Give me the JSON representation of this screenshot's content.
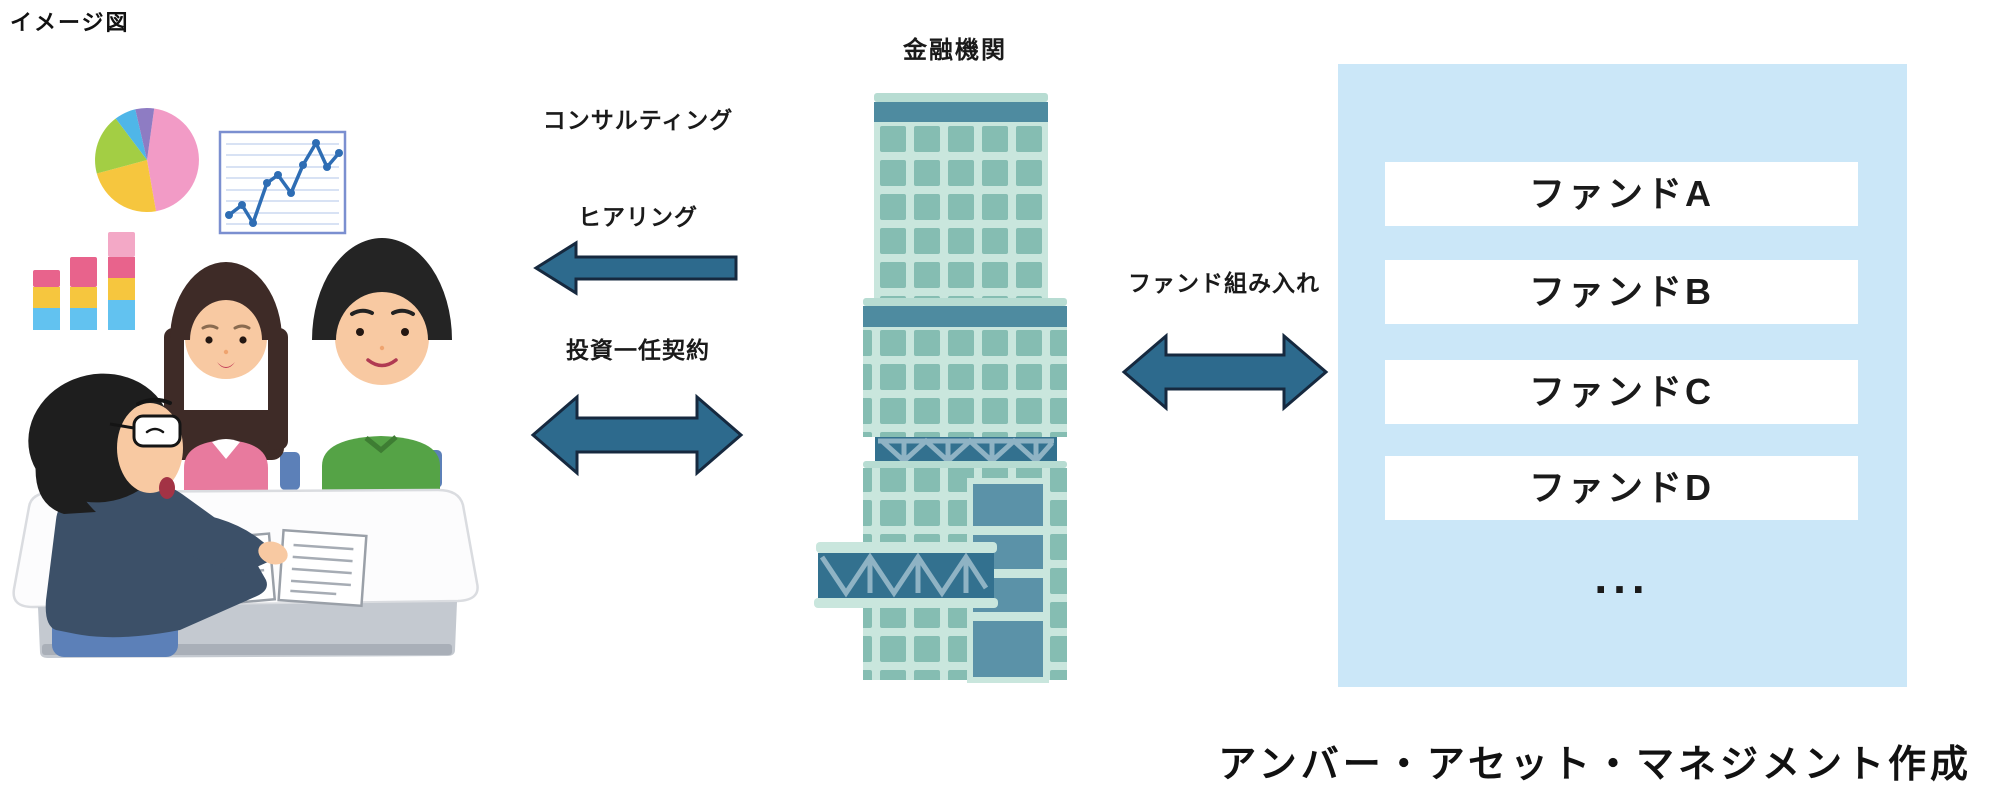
{
  "page": {
    "label_top_left": "イメージ図",
    "credit": "アンバー・アセット・マネジメント作成"
  },
  "left_scene": {
    "icons": [
      "pie-chart",
      "line-chart",
      "stacked-bar-chart",
      "consultant",
      "female-client",
      "male-client",
      "meeting-table",
      "documents",
      "chair"
    ]
  },
  "flows": {
    "consulting": "コンサルティング",
    "hearing": "ヒアリング",
    "mandate": "投資一任契約",
    "fund_inclusion": "ファンド組み入れ"
  },
  "institution": {
    "label": "金融機関"
  },
  "panel": {
    "funds": [
      "ファンドA",
      "ファンドB",
      "ファンドC",
      "ファンドD"
    ],
    "more": "..."
  },
  "colors": {
    "arrow_fill": "#2D6A8D",
    "arrow_stroke": "#16293F",
    "panel_bg": "#CBE7F8",
    "fund_box_bg": "#FFFFFF",
    "text": "#1A1A1A",
    "building_body": "#8FC5BA",
    "building_band": "#4E8BA0",
    "building_truss": "#33718F"
  }
}
